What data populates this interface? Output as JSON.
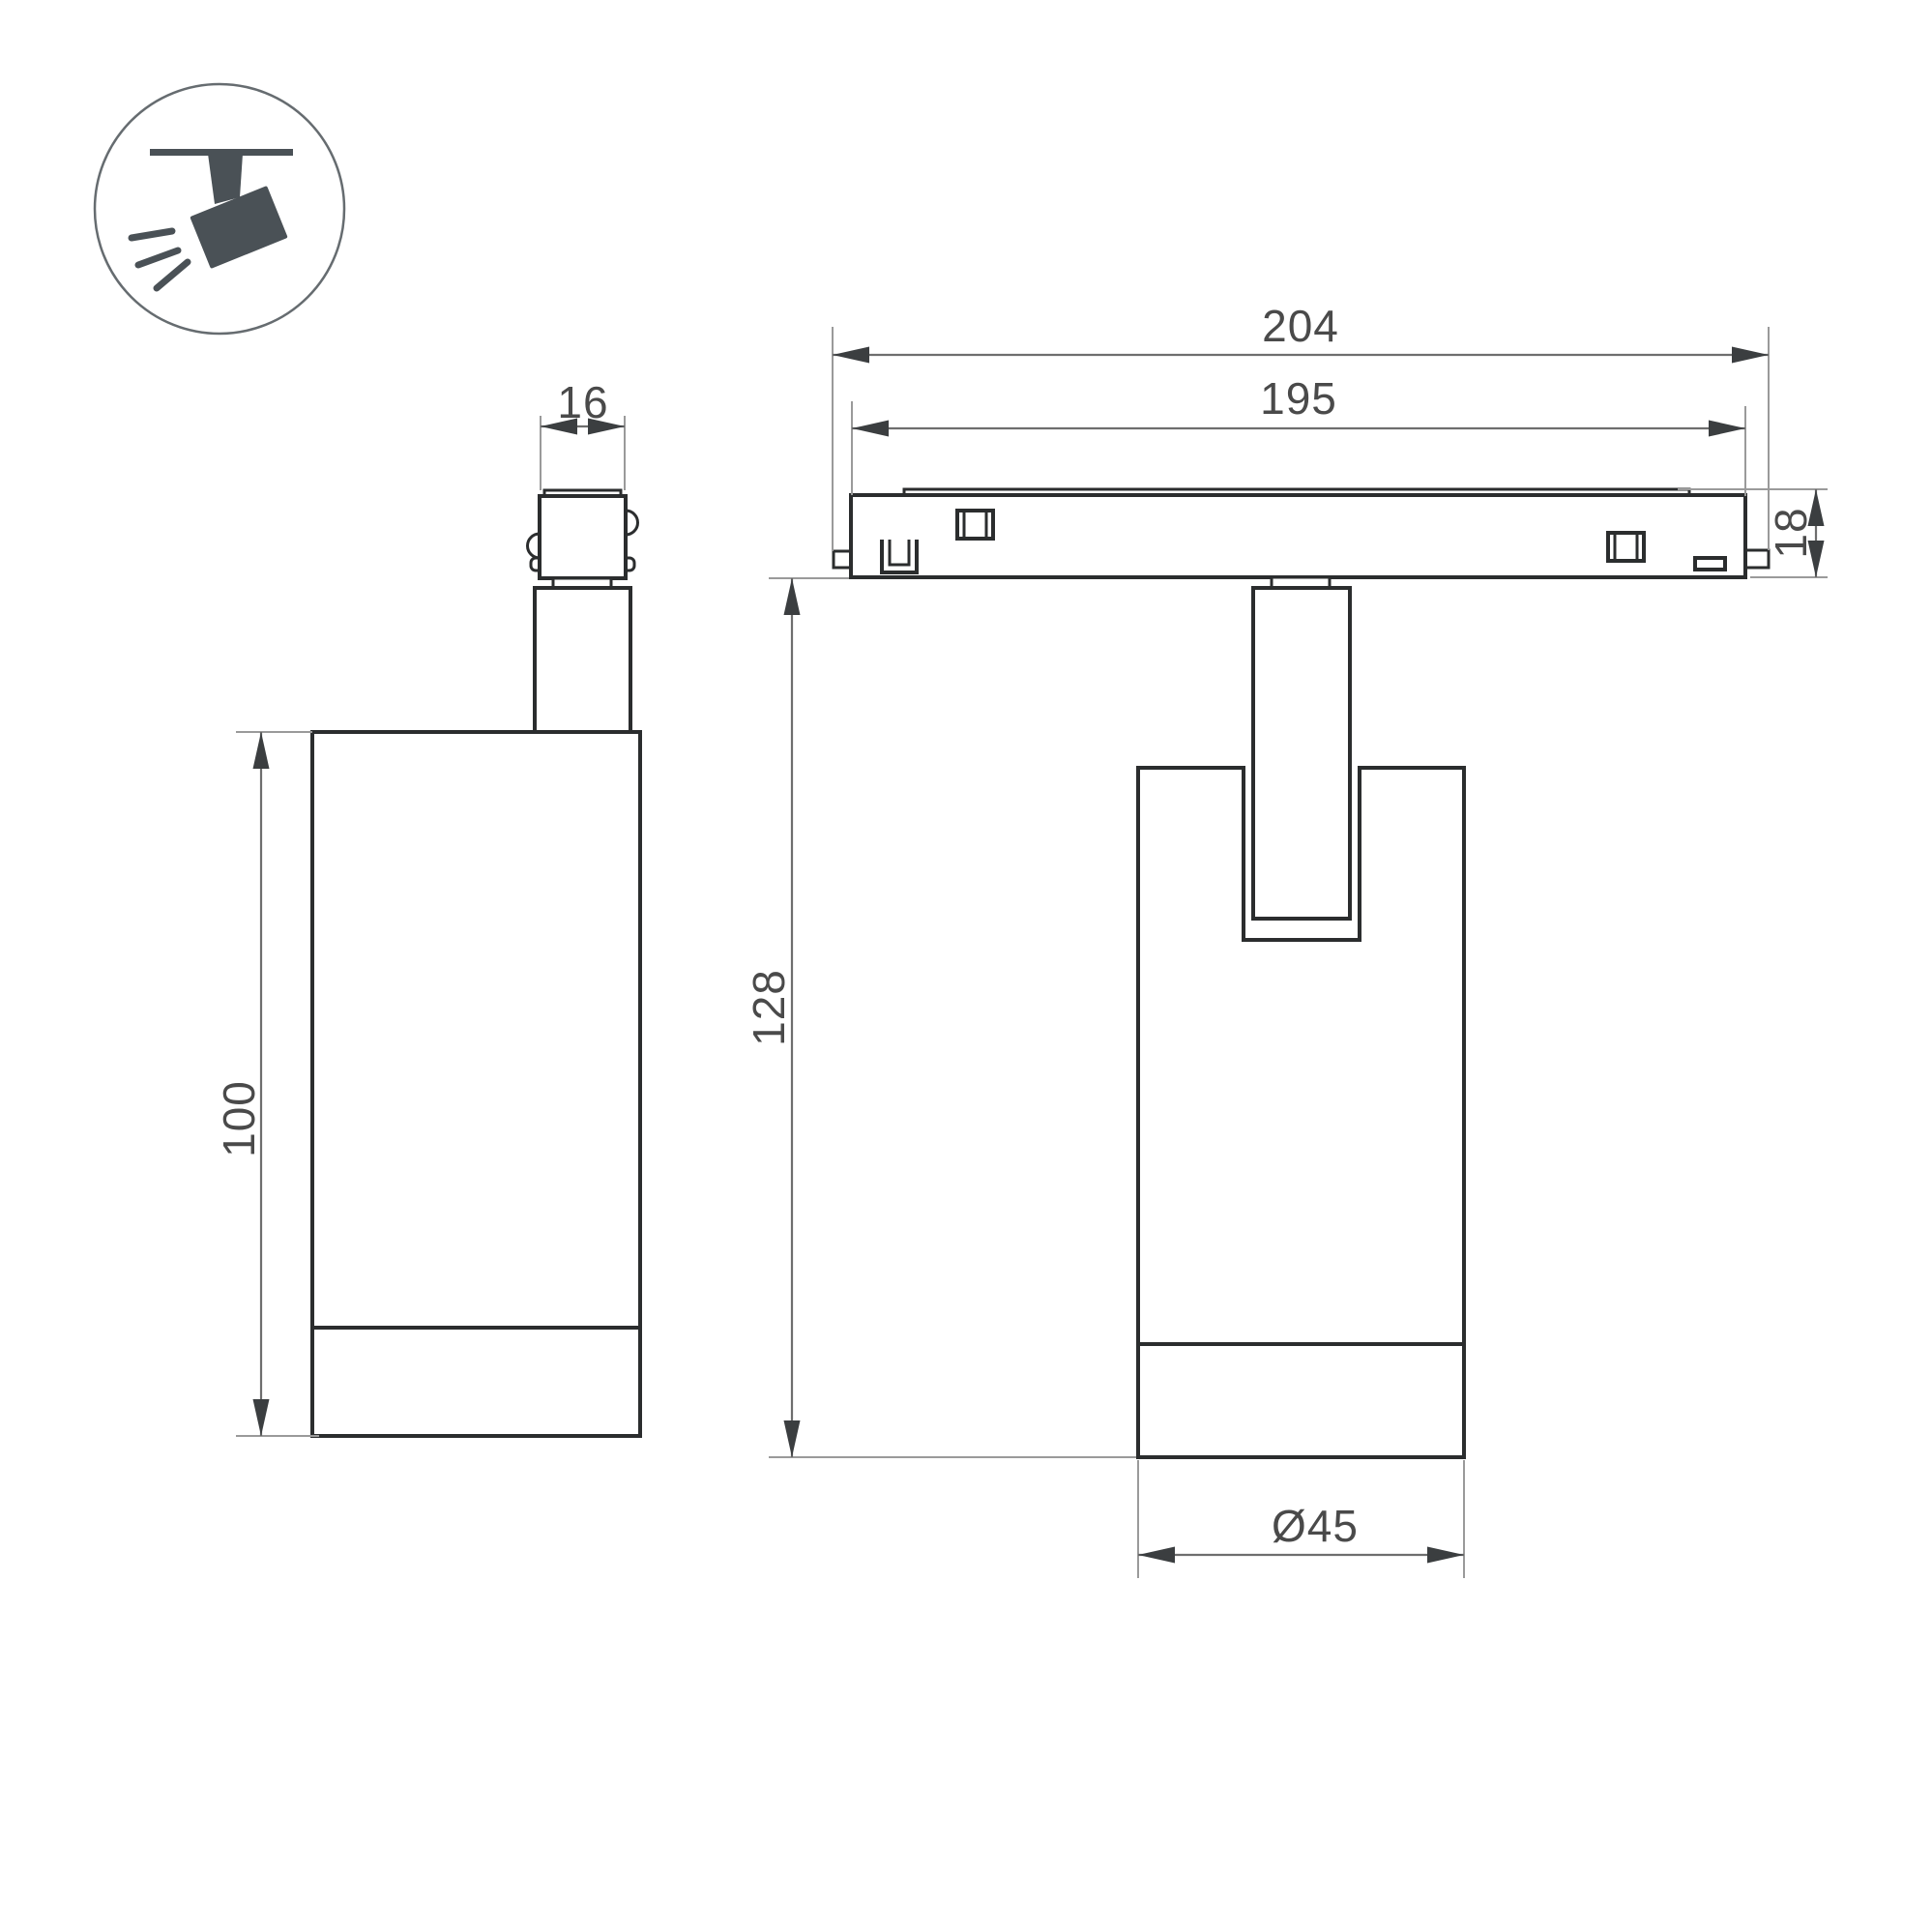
{
  "drawing": {
    "kind": "track-spotlight-technical-drawing",
    "views": {
      "side_view": "side view of spotlight with track connector",
      "front_view": "front view of spotlight mounted on magnetic track"
    }
  },
  "dims": {
    "track_outer": "204",
    "track_inner": "195",
    "connector_width": "16",
    "track_height": "18",
    "body_height": "100",
    "overall_height": "128",
    "body_diameter": "Ø45"
  },
  "icon": {
    "name": "ceiling-track-spotlight-icon"
  },
  "colors": {
    "line-dark": "#2b2d2e",
    "ext-line": "#9a9a9a",
    "dim-line": "#6e6e6e",
    "arrow": "#3b3e40",
    "dim-text": "#4a4a4a",
    "icon": "#4a5156",
    "icon-ring": "#666c70",
    "bg": "#ffffff"
  }
}
